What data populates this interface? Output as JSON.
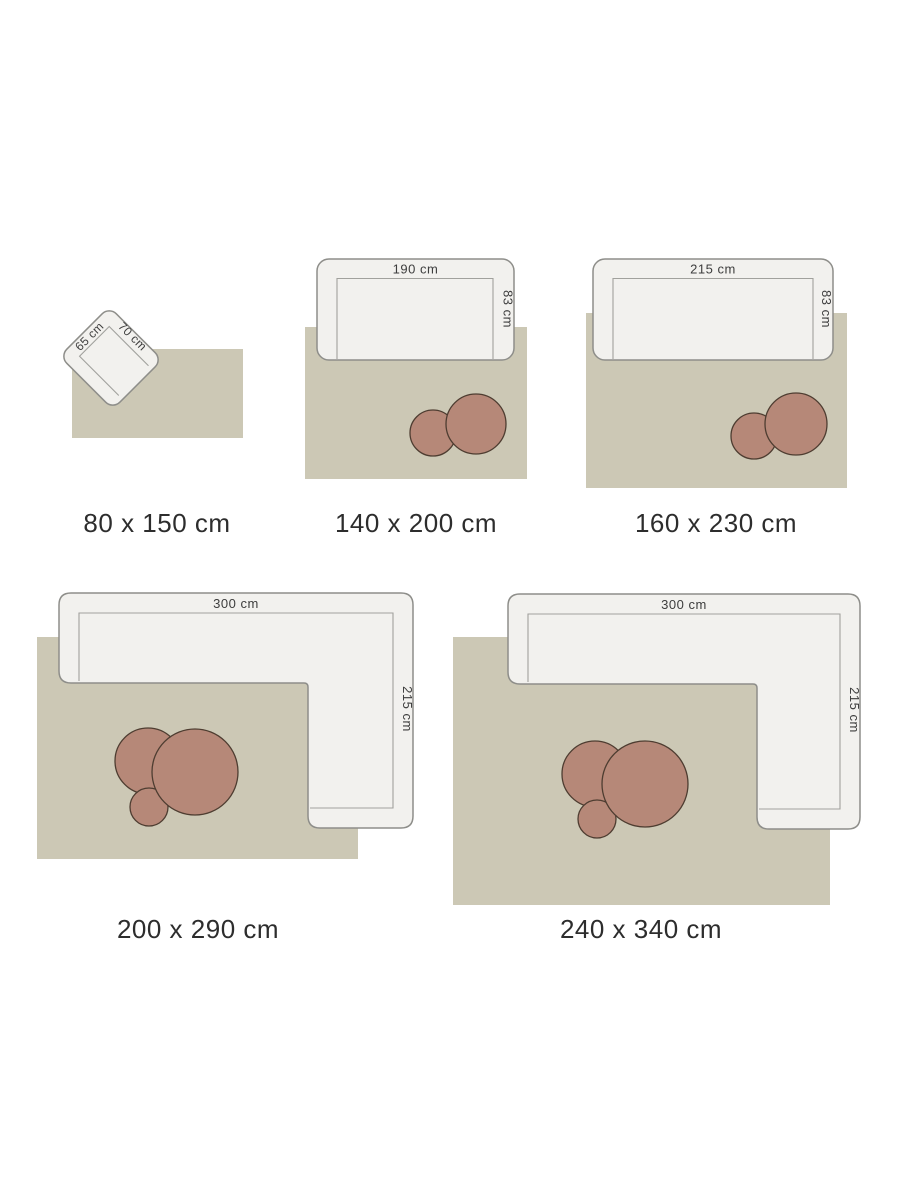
{
  "title": "Rug size guide with furniture for scale",
  "palette": {
    "background": "#ffffff",
    "rug": "#ccc8b5",
    "furniture_fill": "#f2f1ee",
    "furniture_stroke": "#8e8e8a",
    "seat_stroke": "#a1a19d",
    "table_fill": "#b68878",
    "table_stroke": "#4e3d31",
    "dimension_text": "#3d3d3d",
    "size_label_text": "#2d2d2d"
  },
  "panels": [
    {
      "size_label": "80 x 150 cm",
      "furniture": {
        "type": "armchair",
        "width_label": "65 cm",
        "depth_label": "70 cm"
      },
      "table_count": 0
    },
    {
      "size_label": "140 x 200 cm",
      "furniture": {
        "type": "sofa",
        "width_label": "190 cm",
        "depth_label": "83 cm"
      },
      "table_count": 2
    },
    {
      "size_label": "160 x 230 cm",
      "furniture": {
        "type": "sofa",
        "width_label": "215 cm",
        "depth_label": "83 cm"
      },
      "table_count": 2
    },
    {
      "size_label": "200 x 290 cm",
      "furniture": {
        "type": "corner-sofa",
        "width_label": "300 cm",
        "depth_label": "215 cm"
      },
      "table_count": 3
    },
    {
      "size_label": "240 x 340 cm",
      "furniture": {
        "type": "corner-sofa",
        "width_label": "300 cm",
        "depth_label": "215 cm"
      },
      "table_count": 3
    }
  ]
}
